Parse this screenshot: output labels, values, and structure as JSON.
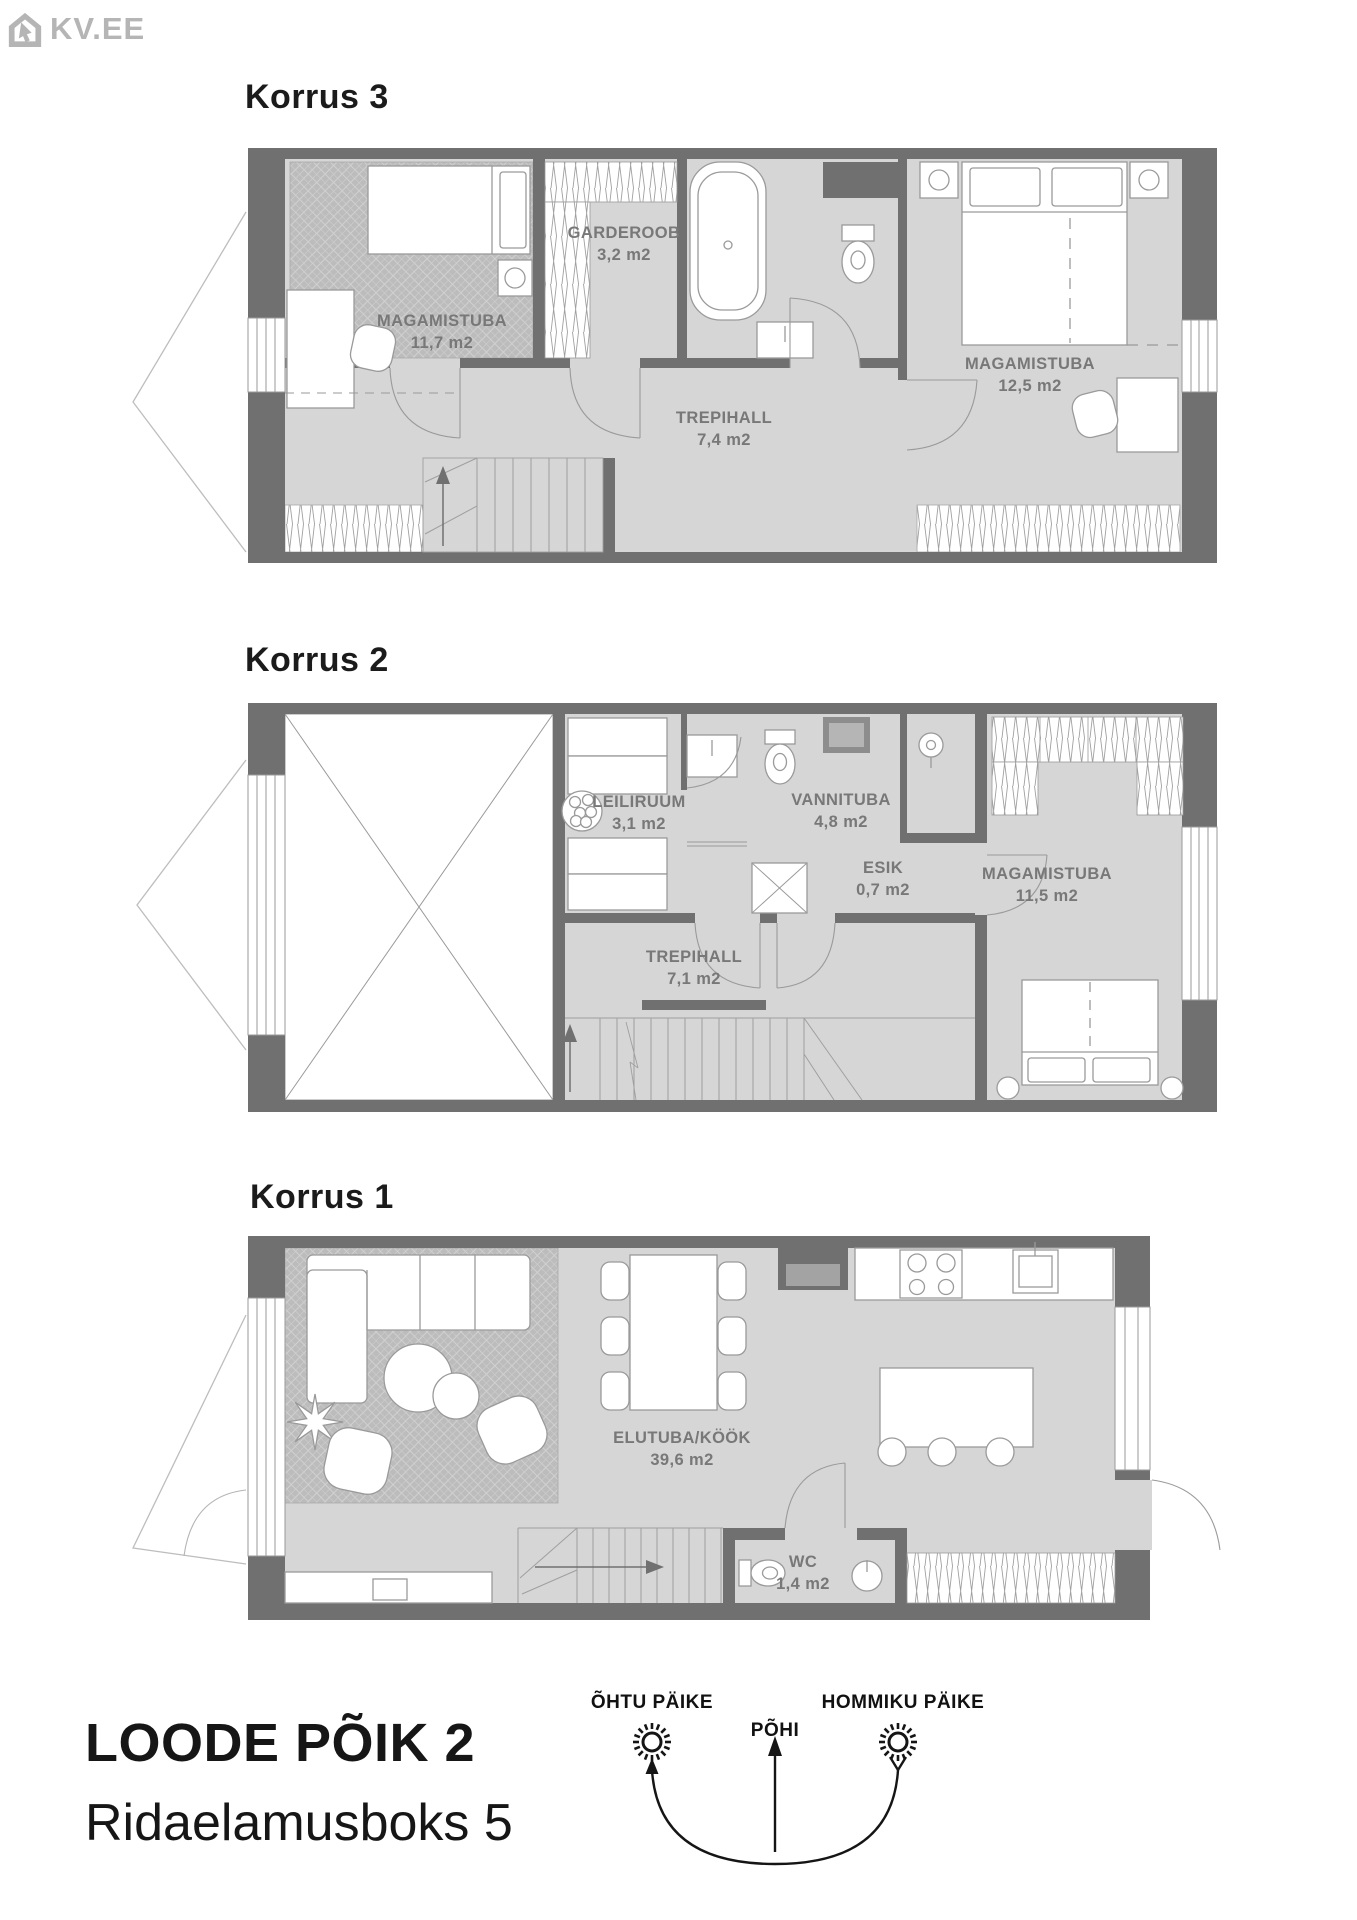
{
  "logo": {
    "text": "KV.EE"
  },
  "floors": [
    {
      "title": "Korrus 3",
      "rooms": [
        {
          "name": "MAGAMISTUBA",
          "area": "11,7 m2"
        },
        {
          "name": "GARDEROOB",
          "area": "3,2 m2"
        },
        {
          "name": "TREPIHALL",
          "area": "7,4 m2"
        },
        {
          "name": "MAGAMISTUBA",
          "area": "12,5 m2"
        }
      ]
    },
    {
      "title": "Korrus 2",
      "rooms": [
        {
          "name": "LEILIRUUM",
          "area": "3,1 m2"
        },
        {
          "name": "VANNITUBA",
          "area": "4,8 m2"
        },
        {
          "name": "ESIK",
          "area": "0,7 m2"
        },
        {
          "name": "MAGAMISTUBA",
          "area": "11,5 m2"
        },
        {
          "name": "TREPIHALL",
          "area": "7,1 m2"
        }
      ]
    },
    {
      "title": "Korrus 1",
      "rooms": [
        {
          "name": "ELUTUBA/KÖÖK",
          "area": "39,6 m2"
        },
        {
          "name": "WC",
          "area": "1,4 m2"
        }
      ]
    }
  ],
  "footer": {
    "address_line1": "LOODE PÕIK 2",
    "address_line2": "Ridaelamusboks 5",
    "compass": {
      "west_label": "ÕHTU PÄIKE",
      "north_label": "PÕHI",
      "east_label": "HOMMIKU PÄIKE"
    }
  },
  "colors": {
    "wall": "#707070",
    "floor": "#d6d6d6",
    "rug": "#bcbcbc",
    "line": "#9a9a9a",
    "label": "#787878",
    "logo": "#b5b5b5",
    "text": "#161616"
  }
}
